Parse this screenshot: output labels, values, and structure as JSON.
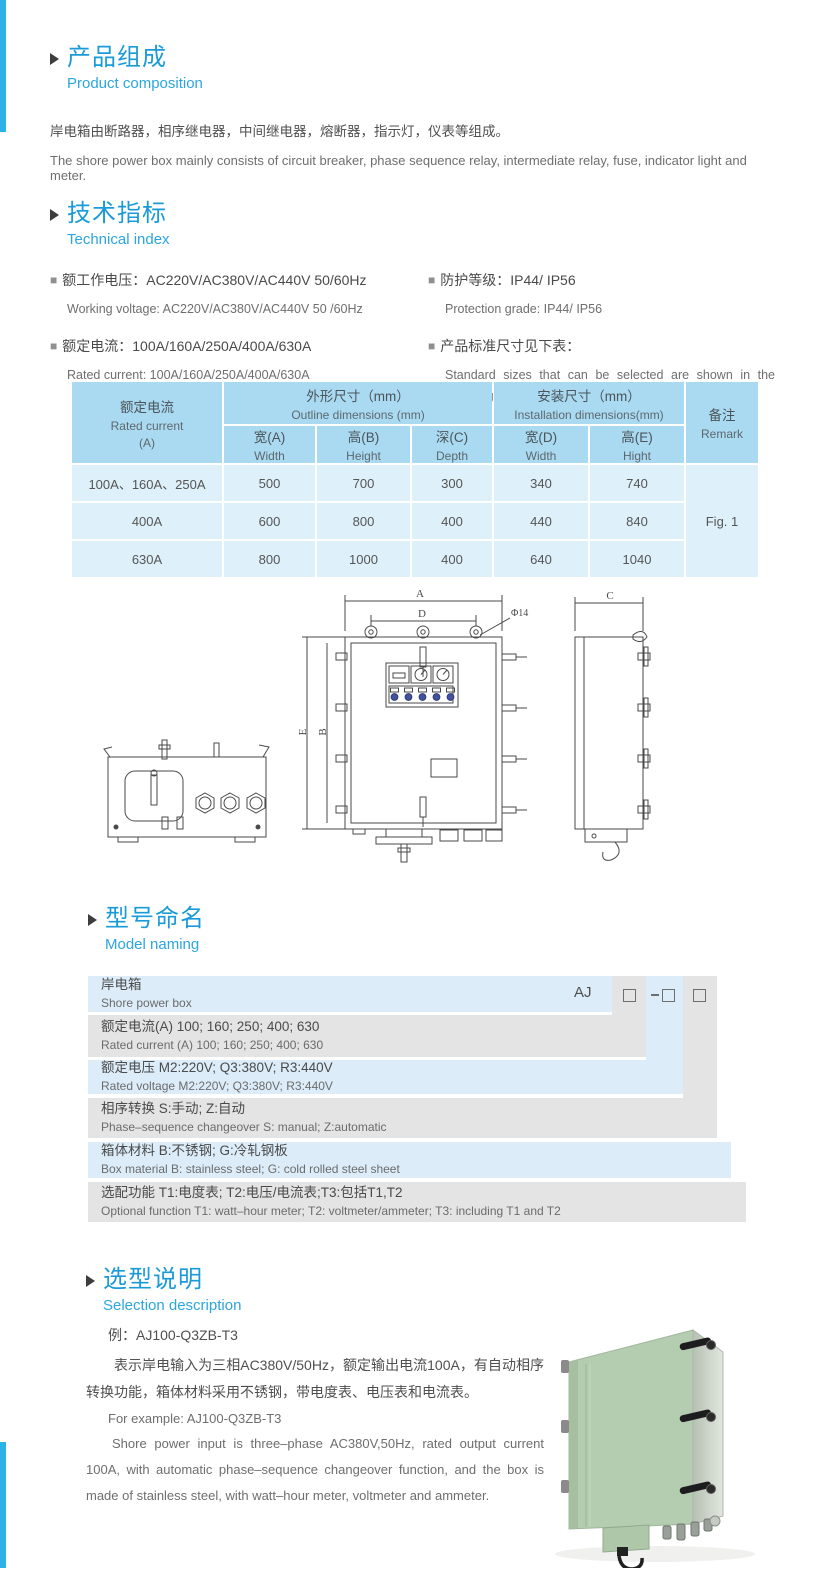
{
  "colors": {
    "accent": "#1a9bd7",
    "accent_light": "#2ba6de",
    "edge_stripe": "#2bb3e8",
    "table_header_bg": "#aadaf1",
    "table_row_bg": "#def0fa",
    "naming_row_blue": "#dcedf9",
    "naming_row_grey": "#e4e4e4",
    "cabinet_green": "#b4ccb0"
  },
  "composition": {
    "title_cn": "产品组成",
    "title_en": "Product  composition",
    "body_cn": "岸电箱由断路器，相序继电器，中间继电器，熔断器，指示灯，仪表等组成。",
    "body_en": "The shore power box mainly consists of circuit breaker, phase sequence relay, intermediate relay, fuse, indicator light and meter."
  },
  "technical": {
    "title_cn": "技术指标",
    "title_en": "Technical index",
    "items": [
      {
        "cn": "额工作电压：AC220V/AC380V/AC440V  50/60Hz",
        "en": "Working voltage: AC220V/AC380V/AC440V 50 /60Hz"
      },
      {
        "cn": "防护等级：IP44/ IP56",
        "en": "Protection grade: IP44/ IP56"
      },
      {
        "cn": "额定电流：100A/160A/250A/400A/630A",
        "en": "Rated current: 100A/160A/250A/400A/630A"
      },
      {
        "cn": "产品标准尺寸见下表：",
        "en": "Standard sizes that can be selected are shown in the following table"
      }
    ]
  },
  "spec_table": {
    "header": {
      "rated_cn": "额定电流",
      "rated_en": "Rated current",
      "rated_unit": "(A)",
      "outline_cn": "外形尺寸（mm）",
      "outline_en": "Outline dimensions (mm)",
      "install_cn": "安装尺寸（mm）",
      "install_en": "Installation dimensions(mm)",
      "remark_cn": "备注",
      "remark_en": "Remark",
      "sub": [
        {
          "cn": "宽(A)",
          "en": "Width"
        },
        {
          "cn": "高(B)",
          "en": "Height"
        },
        {
          "cn": "深(C)",
          "en": "Depth"
        },
        {
          "cn": "宽(D)",
          "en": "Width"
        },
        {
          "cn": "高(E)",
          "en": "Hight"
        }
      ]
    },
    "rows": [
      {
        "rated": "100A、160A、250A",
        "w": "500",
        "h": "700",
        "d": "300",
        "iw": "340",
        "ih": "740"
      },
      {
        "rated": "400A",
        "w": "600",
        "h": "800",
        "d": "400",
        "iw": "440",
        "ih": "840"
      },
      {
        "rated": "630A",
        "w": "800",
        "h": "1000",
        "d": "400",
        "iw": "640",
        "ih": "1040"
      }
    ],
    "remark_value": "Fig. 1"
  },
  "drawing": {
    "labels": {
      "a": "A",
      "b": "B",
      "c": "C",
      "d": "D",
      "e": "E",
      "hole": "Φ14"
    }
  },
  "model_naming": {
    "title_cn": "型号命名",
    "title_en": "Model naming",
    "prefix": "AJ",
    "rows": [
      {
        "cn": "岸电箱",
        "en": "Shore power box"
      },
      {
        "cn": "额定电流(A)  100; 160; 250; 400; 630",
        "en": "Rated current (A) 100; 160; 250; 400; 630"
      },
      {
        "cn": "额定电压   M2:220V;  Q3:380V;  R3:440V",
        "en": "Rated voltage  M2:220V;  Q3:380V;  R3:440V"
      },
      {
        "cn": "相序转换  S:手动; Z:自动",
        "en": "Phase–sequence changeover  S: manual;  Z:automatic"
      },
      {
        "cn": "箱体材料    B:不锈钢;  G:冷轧钢板",
        "en": "Box material   B: stainless steel; G: cold rolled steel sheet"
      },
      {
        "cn": "选配功能     T1:电度表;  T2:电压/电流表;T3:包括T1,T2",
        "en": "Optional function  T1: watt–hour meter; T2: voltmeter/ammeter; T3: including T1 and T2"
      }
    ]
  },
  "selection": {
    "title_cn": "选型说明",
    "title_en": "Selection description",
    "example_cn": "例：AJ100-Q3ZB-T3",
    "para_cn": "表示岸电输入为三相AC380V/50Hz，额定输出电流100A，有自动相序转换功能，箱体材料采用不锈钢，带电度表、电压表和电流表。",
    "example_en": "For example: AJ100-Q3ZB-T3",
    "para_en": "Shore power input is three–phase AC380V,50Hz, rated output current 100A, with automatic phase–sequence changeover function, and the box is made of stainless steel, with watt–hour meter, voltmeter and ammeter."
  }
}
